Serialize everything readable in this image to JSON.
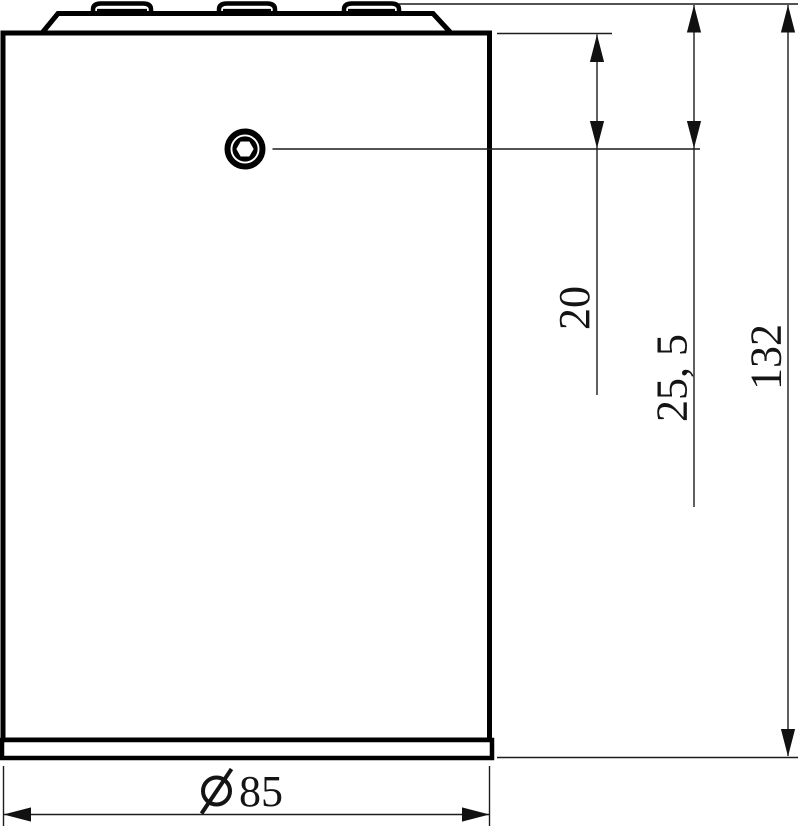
{
  "meta": {
    "type": "technical-drawing",
    "view": "side-view dimension drawing of a cylindrical housing with three top tabs and a hex-socket set screw"
  },
  "colors": {
    "background": "#ffffff",
    "part_outline": "#000000",
    "dimension_line": "#1c1c1c",
    "text": "#141414"
  },
  "dimensions": {
    "screw_to_shoulder": {
      "label": "20",
      "value": 20
    },
    "screw_to_top": {
      "label": "25, 5",
      "value": 25.5
    },
    "overall_height": {
      "label": "132",
      "value": 132
    },
    "body_diameter": {
      "label": "85",
      "value": 85,
      "symbol": "Ø"
    }
  },
  "icons": {
    "hex_socket_screw": "hex-socket-screw-icon",
    "diameter_symbol": "diameter-symbol-icon"
  }
}
